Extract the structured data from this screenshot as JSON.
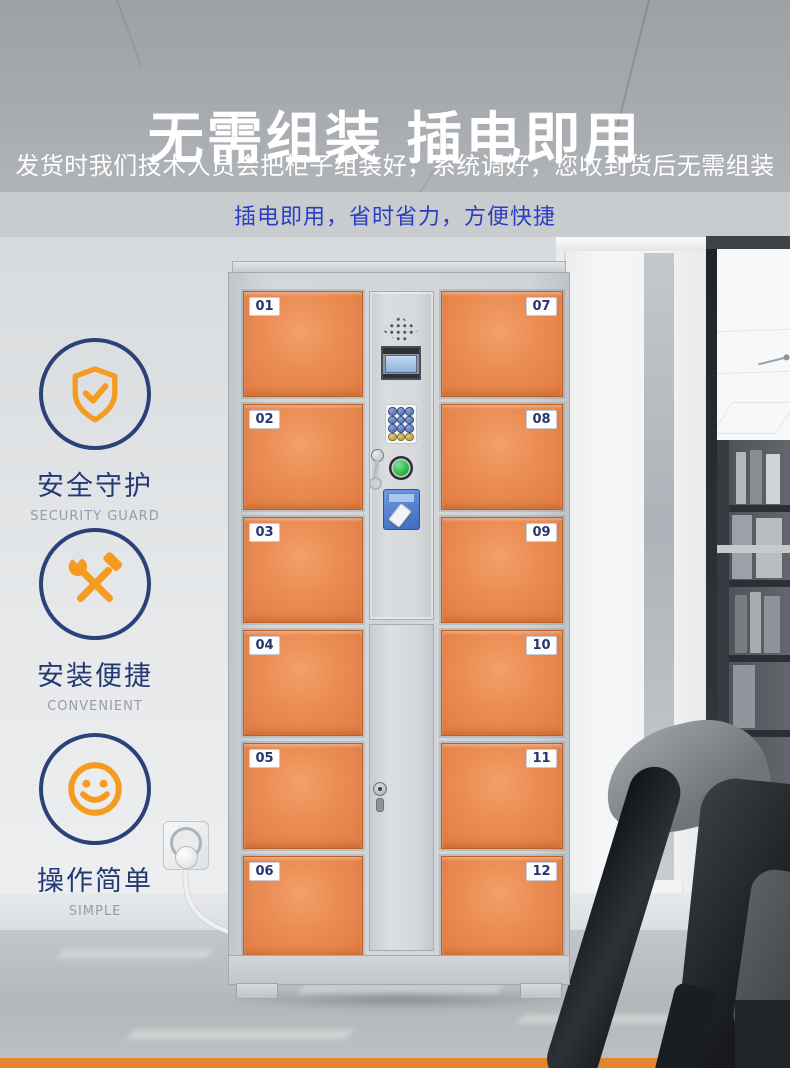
{
  "header": {
    "title": "无需组装 插电即用",
    "subtitle": "发货时我们技术人员会把柜子组装好，系统调好，您收到货后无需组装",
    "tagline": "插电即用，省时省力，方便快捷"
  },
  "features": [
    {
      "title": "安全守护",
      "caption": "SECURITY GUARD",
      "icon": "shield-check-icon"
    },
    {
      "title": "安装便捷",
      "caption": "CONVENIENT",
      "icon": "tools-icon"
    },
    {
      "title": "操作简单",
      "caption": "SIMPLE",
      "icon": "smiley-icon"
    }
  ],
  "locker": {
    "doors": {
      "left": [
        "01",
        "02",
        "03",
        "04",
        "05",
        "06"
      ],
      "right": [
        "07",
        "08",
        "09",
        "10",
        "11",
        "12"
      ]
    }
  },
  "colors": {
    "accent_orange": "#f59b1f",
    "door_orange": "#e5834a",
    "navy_circle": "#2c4079",
    "tagline_blue": "#2b3ec2",
    "bottom_strip_orange": "#e2872e"
  }
}
